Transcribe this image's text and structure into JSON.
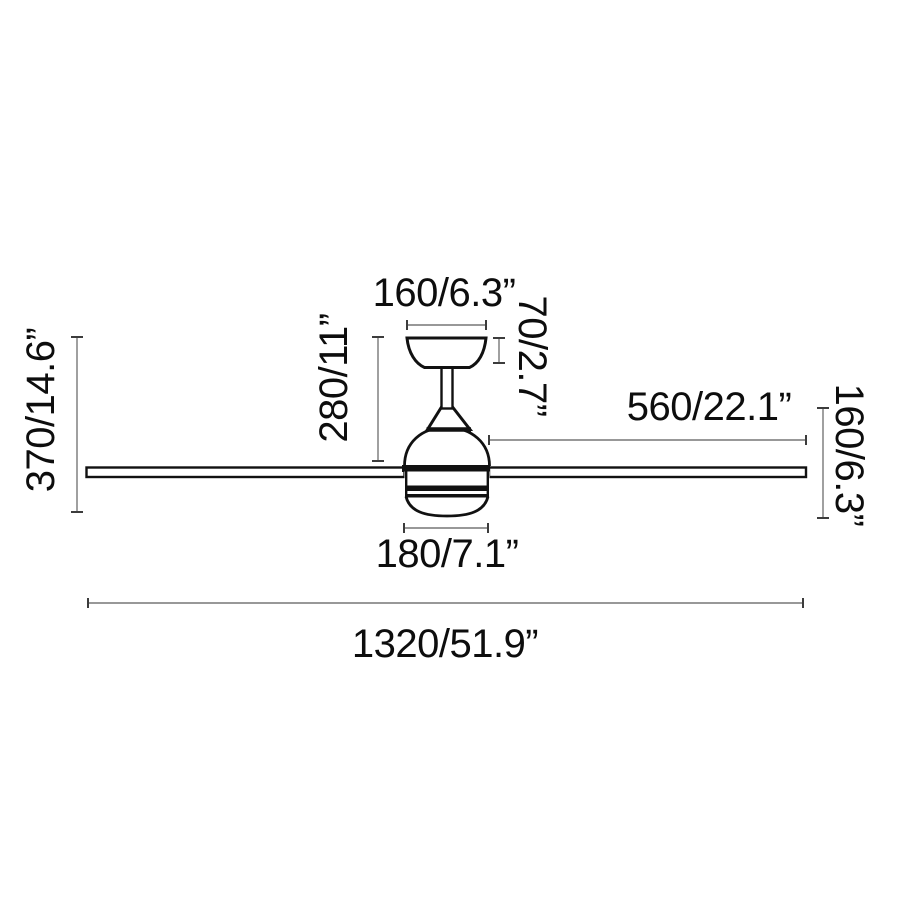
{
  "diagram": {
    "type": "technical-dimension-drawing",
    "subject": "ceiling-fan-side-view",
    "unit_format": "mm/inch",
    "dimensions": {
      "canopy_width": "160/6.3”",
      "canopy_height": "70/2.7”",
      "ceiling_to_blades": "280/11”",
      "total_height": "370/14.6”",
      "blade_length": "560/22.1”",
      "body_height": "160/6.3”",
      "motor_width": "180/7.1”",
      "total_diameter": "1320/51.9”"
    },
    "colors": {
      "drawing_line": "#111111",
      "dimension_line": "#777777",
      "dimension_tick": "#3c3c3c",
      "text": "#0d0d0d",
      "background": "#ffffff"
    }
  }
}
